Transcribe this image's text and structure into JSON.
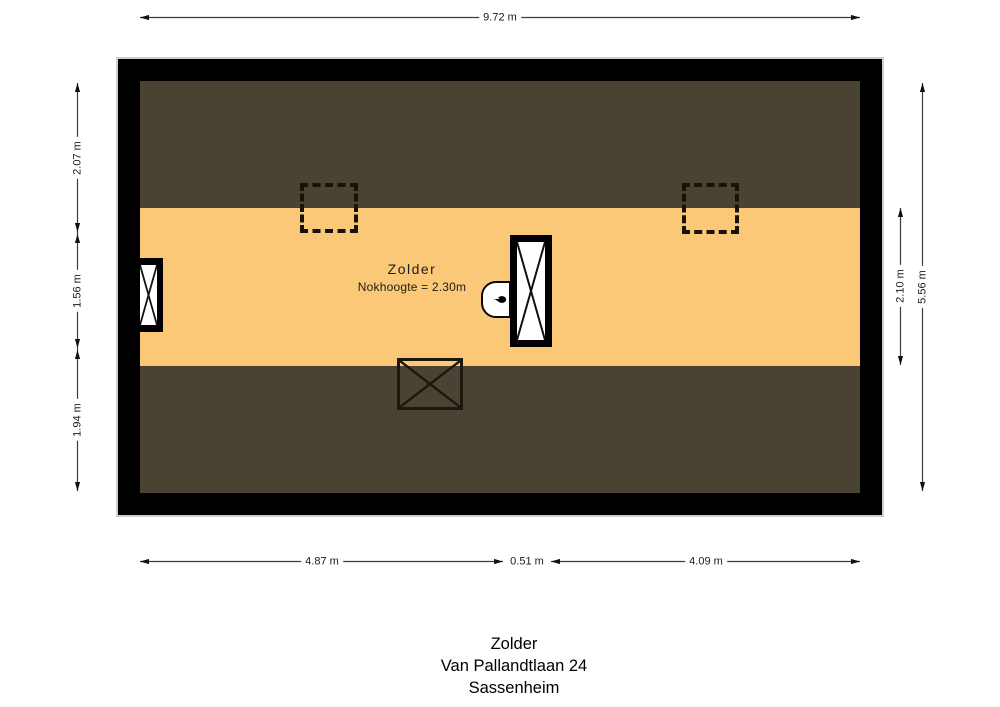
{
  "room": {
    "name": "Zolder",
    "ridge_height_note": "Nokhoogte = 2.30m"
  },
  "dimensions": {
    "top": {
      "total_width": "9.72 m"
    },
    "bottom": {
      "left_segment": "4.87 m",
      "middle_segment": "0.51 m",
      "right_segment": "4.09 m"
    },
    "left": {
      "top_segment": "2.07 m",
      "middle_segment": "1.56 m",
      "bottom_segment": "1.94 m"
    },
    "right": {
      "floor_band_height": "2.10 m",
      "total_height": "5.56 m"
    }
  },
  "caption": {
    "room": "Zolder",
    "street": "Van Pallandtlaan 24",
    "city": "Sassenheim"
  },
  "colors": {
    "wall": "#000000",
    "roof_area": "#4a4233",
    "floor_area": "#fbc878",
    "background": "#ffffff"
  },
  "icons": {
    "boiler": "flame-icon"
  }
}
